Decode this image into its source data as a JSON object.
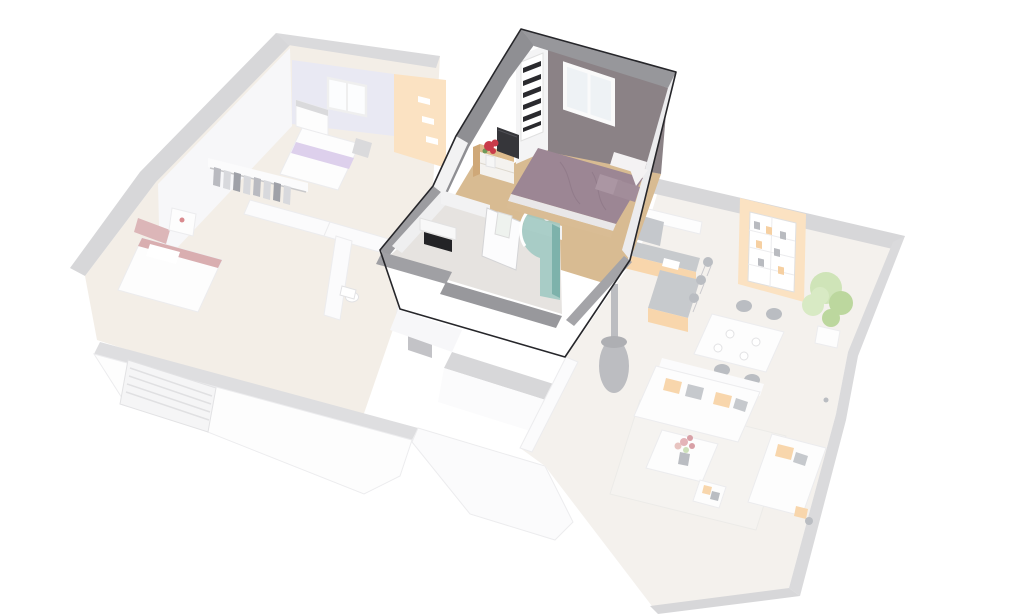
{
  "scene": {
    "type": "isometric-3d-floorplan-render",
    "background": "#ffffff",
    "selection": {
      "selected_region": "master-suite",
      "selected_style": "saturated-with-dark-outline",
      "unselected_style": "faded-near-white"
    }
  },
  "regions": [
    {
      "id": "master-suite",
      "state": "highlighted",
      "contents": [
        "bedroom",
        "bathroom-with-shower"
      ]
    },
    {
      "id": "left-wing-upper-floor",
      "state": "faded",
      "contents": [
        "lavender-bedroom",
        "maroon-bedroom",
        "dressing-closet",
        "wc",
        "hallway"
      ]
    },
    {
      "id": "right-wing-living",
      "state": "faded",
      "contents": [
        "kitchen",
        "dining",
        "living-room",
        "wood-stove",
        "stairs"
      ]
    },
    {
      "id": "ground-floor",
      "state": "faded",
      "contents": [
        "garage",
        "entry"
      ]
    }
  ],
  "colors": {
    "background": "#ffffff",
    "outline_dark": "#26262a",
    "roof_band": "#8f8f93",
    "roof_band_light": "#97979b",
    "wall_cap": "#9c9ca0",
    "wall_cap_front": "#a0a0a4",
    "wall_cap_front2": "#98989c",
    "wall_cap_right": "#a4a4a8",
    "suite_white": "#ffffff",
    "suite_wall_white": "#f4f4f5",
    "suite_wall_inner": "#efeff0",
    "suite_wall_face": "#f2f2f3",
    "suite_wall_sliver": "#ececee",
    "bedroom_wall_taupe": "#8b8286",
    "window_glass": "#eef2f5",
    "wood_floor": "#d8bb92",
    "bath_floor": "#e6e3e0",
    "bed_duvet": "#9c8694",
    "bed_pillow": "#ab96a3",
    "bed_pillow_dark": "#a28d9a",
    "bed_white": "#f4f2f3",
    "mattress_edge": "#e9e7e8",
    "bed_frame_wood": "#d9bc94",
    "dresser_wood": "#ddbb8c",
    "dresser_wood_side": "#cfa878",
    "dresser_front": "#f4f2ef",
    "tv_screen": "#36363a",
    "flower_red": "#c93b4a",
    "vase_white": "#f6f6f6",
    "shower_glass": "#9fc8c1",
    "shower_glass_dark": "#7db2ab",
    "basin_cabinet": "#232326",
    "basin_top": "#f8f8f8",
    "shelf_items": "#2a2a2e",
    "door_white": "#fcfcfd",
    "divider_wall": "#f2f2f3",
    "faded": {
      "band": "#d7d7d9",
      "band_light": "#dadadc",
      "floor_warm": "#f3eee7",
      "floor_cool": "#f4f1ed",
      "wall": "#f7f7f9",
      "wall_bright": "#fbfbfc",
      "lavender": "#e9e9f3",
      "peach": "#fbe2c2",
      "orange": "#f8d6ac",
      "counter_grey": "#c7cacd",
      "appliance_grey": "#c5c8cc",
      "item_dark": "#babdc2",
      "maroon": "#dcb6b8",
      "maroon_light": "#d9aeb0",
      "purple_stripe": "#ddd0ec",
      "green": "#cfe4b8",
      "green_dark": "#bcd79e",
      "green_pale": "#d8eac4",
      "white": "#fdfdfd",
      "stair": "#c3c4c9",
      "door": "#c3c3c7",
      "slab_band": "#dedee0",
      "stove": "#bcbdc1",
      "stove_cap": "#aeafb3"
    }
  }
}
